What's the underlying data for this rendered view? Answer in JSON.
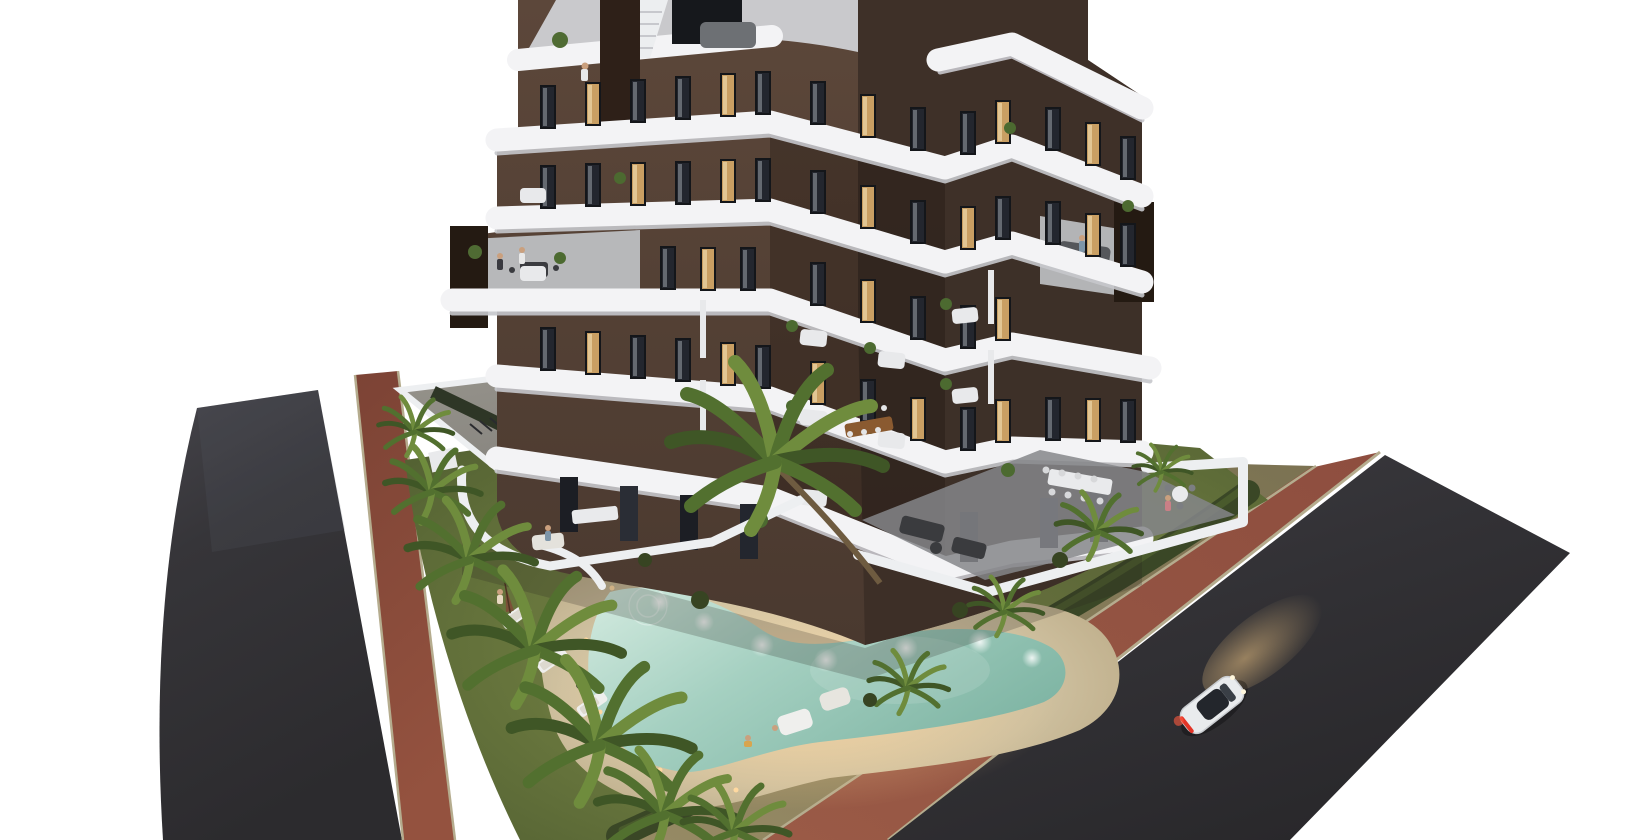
{
  "meta": {
    "title": "Aerial 3D architectural render - apartment complex with pool at dusk",
    "type": "architectural-visualization",
    "time_of_day": "dusk",
    "camera": "high aerial three-quarter view, building corner facing viewer, white cut-out background"
  },
  "palette": {
    "background": "#ffffff",
    "asphalt": "#323135",
    "asphalt_light": "#47464b",
    "red_path": "#8e4e3f",
    "red_path_dark": "#7c4335",
    "verge": "#8a8162",
    "curb": "#b5ac8e",
    "lawn": "#66743c",
    "lawn_light": "#7e8e4a",
    "lawn_dark": "#4c5a2f",
    "hedge": "#3a4726",
    "sand": "#cfc1a0",
    "sand_light": "#e5d8b8",
    "pool_light": "#cfe7dc",
    "pool_mid": "#a5d0c1",
    "pool_deep": "#7fb5a4",
    "facade_left": "#554236",
    "facade_right": "#3c2f27",
    "facade_dark": "#2f241d",
    "band_white": "#f3f3f5",
    "band_shadow": "#c6c7cc",
    "window_dark": "#1e2026",
    "window_lit": "#c99f63",
    "tile": "#8f9094",
    "wall_white": "#edeff1",
    "trunk": "#6e5b40",
    "palm": "#52702f",
    "palm_light": "#6f8c3d",
    "palm_dark": "#3f5626",
    "umbrella": "#7b5138",
    "car_body": "#e9ebed",
    "car_glass": "#23262c",
    "taillight": "#e33427",
    "headlight_beam": "#ffd28c",
    "gravel": "#a89d80",
    "concrete": "#8c8a84",
    "furniture_dark": "#3a3b3e",
    "table_wood": "#8a5a30"
  },
  "scene": {
    "building": {
      "label": "V-shaped apartment tower, dark brown facade with white curved wrap-around balcony bands",
      "floors_visible": 7,
      "top_cut_off": true,
      "features": [
        "rooftop terrace with white staircase and dark chimney",
        "4th-floor roof terraces with chimneys, furniture and people",
        "recessed corner balconies with white sofas and plants",
        "ground-floor terraces with dining tables, lounge sets and people",
        "mix of dark and warm-lit windows"
      ]
    },
    "pool": {
      "label": "boomerang-shaped swimming pool with glowing turquoise water",
      "underwater_lights": 7,
      "deck": "sand-colored beach deck with 3 sun loungers, closed brown umbrellas and white lounge seats"
    },
    "garden": {
      "label": "lawn with palm trees, hedges, gravel planting island with tall palm, path lights"
    },
    "roads": {
      "left": "dark asphalt road, curved, bottom-left",
      "right": "wide dark asphalt road, diagonal, bottom-right",
      "bike_paths": "red-brown strips with light curbs along both roads",
      "verge": "olive-tan strip between right bike path and white property wall"
    },
    "car": {
      "label": "white coupe driving up the right road",
      "details": [
        "red taillights",
        "warm headlight beam on asphalt",
        "dark glass roof"
      ]
    },
    "people": "small figures on rooftop, balconies, terraces and pool deck"
  }
}
